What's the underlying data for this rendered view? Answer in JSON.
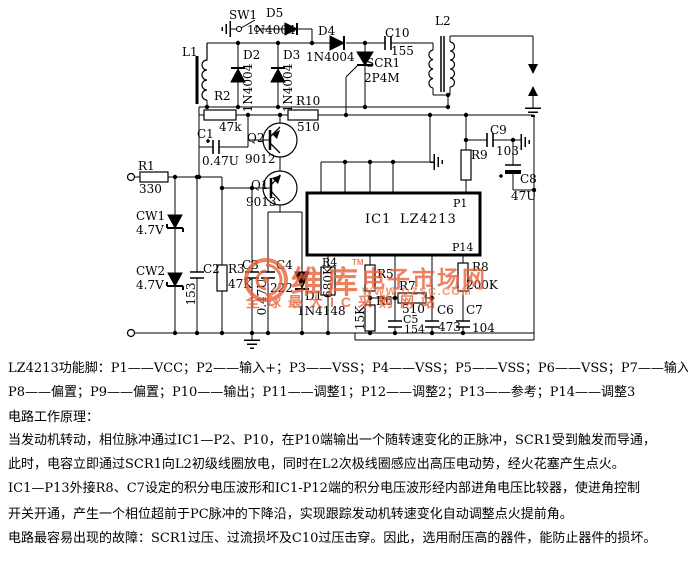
{
  "colors": {
    "circuit": "#000000",
    "background": "#ffffff",
    "watermark_orange": "#e95f38",
    "watermark_light": "#ef7b50"
  },
  "ic": {
    "ref": "IC1",
    "part": "LZ4213",
    "pin_top": "P1",
    "pin_bottom": "P14"
  },
  "components": {
    "l1": {
      "ref": "L1"
    },
    "sw1": {
      "ref": "SW1"
    },
    "d5": {
      "ref": "D5",
      "value": "1N4004"
    },
    "d4": {
      "ref": "D4",
      "value": "1N4004"
    },
    "c10": {
      "ref": "C10",
      "value": "155"
    },
    "l2": {
      "ref": "L2"
    },
    "scr1": {
      "ref": "SCR1",
      "value": "2P4M"
    },
    "d2": {
      "ref": "D2",
      "value": "1N4004"
    },
    "d3": {
      "ref": "D3",
      "value": "1N4004"
    },
    "r2": {
      "ref": "R2",
      "value": "47k"
    },
    "r10": {
      "ref": "R10",
      "value": "510"
    },
    "c1": {
      "ref": "C1",
      "value": "0.47U"
    },
    "q2": {
      "ref": "Q2",
      "value": "9012"
    },
    "q1": {
      "ref": "Q1",
      "value": "9013"
    },
    "r1": {
      "ref": "R1",
      "value": "330"
    },
    "cw1": {
      "ref": "CW1",
      "value": "4.7V"
    },
    "cw2": {
      "ref": "CW2",
      "value": "4.7V"
    },
    "c2": {
      "ref": "C2",
      "value": "153"
    },
    "r3": {
      "ref": "R3",
      "value": "47K"
    },
    "c3": {
      "ref": "C3",
      "value": "0.47U"
    },
    "c4": {
      "ref": "C4",
      "value": "222"
    },
    "d1": {
      "ref": "D1",
      "value": "1N4148"
    },
    "r4": {
      "ref": "R4",
      "value": "680K"
    },
    "r5": {
      "ref": "R5"
    },
    "r6": {
      "ref": "R6",
      "value": "15K"
    },
    "r7": {
      "ref": "R7",
      "value": "510"
    },
    "c5": {
      "ref": "C5",
      "value": "154"
    },
    "c6": {
      "ref": "C6",
      "value": "473"
    },
    "c7": {
      "ref": "C7",
      "value": "104"
    },
    "r8": {
      "ref": "R8",
      "value": "200K"
    },
    "r9": {
      "ref": "R9"
    },
    "c9": {
      "ref": "C9",
      "value": "103"
    },
    "c8": {
      "ref": "C8",
      "value": "47U"
    }
  },
  "watermark": {
    "brand": "维库",
    "tm": "TM",
    "suffix": "电子市场网",
    "url": "WWW.DZSC.COM",
    "tagline": "全球最大IC采购网站"
  },
  "description": {
    "lines": [
      "LZ4213功能脚：P1——VCC；P2——输入+；P3——VSS；P4——VSS；P5——VSS；P6——VSS；P7——输入-",
      "P8——偏置；P9——偏置；P10——输出；P11——调整1；P12——调整2；P13——参考；P14——调整3",
      "电路工作原理：",
      "当发动机转动，相位脉冲通过IC1—P2、P10，在P10端输出一个随转速变化的正脉冲，SCR1受到触发而导通，",
      "此时，电容立即通过SCR1向L2初级线圈放电，同时在L2次极线圈感应出高压电动势，经火花塞产生点火。",
      "IC1—P13外接R8、C7设定的积分电压波形和IC1-P12端的积分电压波形经内部进角电压比较器，使进角控制",
      "开关开通，产生一个相位超前于PC脉冲的下降沿，实现跟踪发动机转速变化自动调整点火提前角。",
      "电路最容易出现的故障：SCR1过压、过流损坏及C10过压击穿。因此，选用耐压高的器件，能防止器件的损坏。"
    ]
  }
}
